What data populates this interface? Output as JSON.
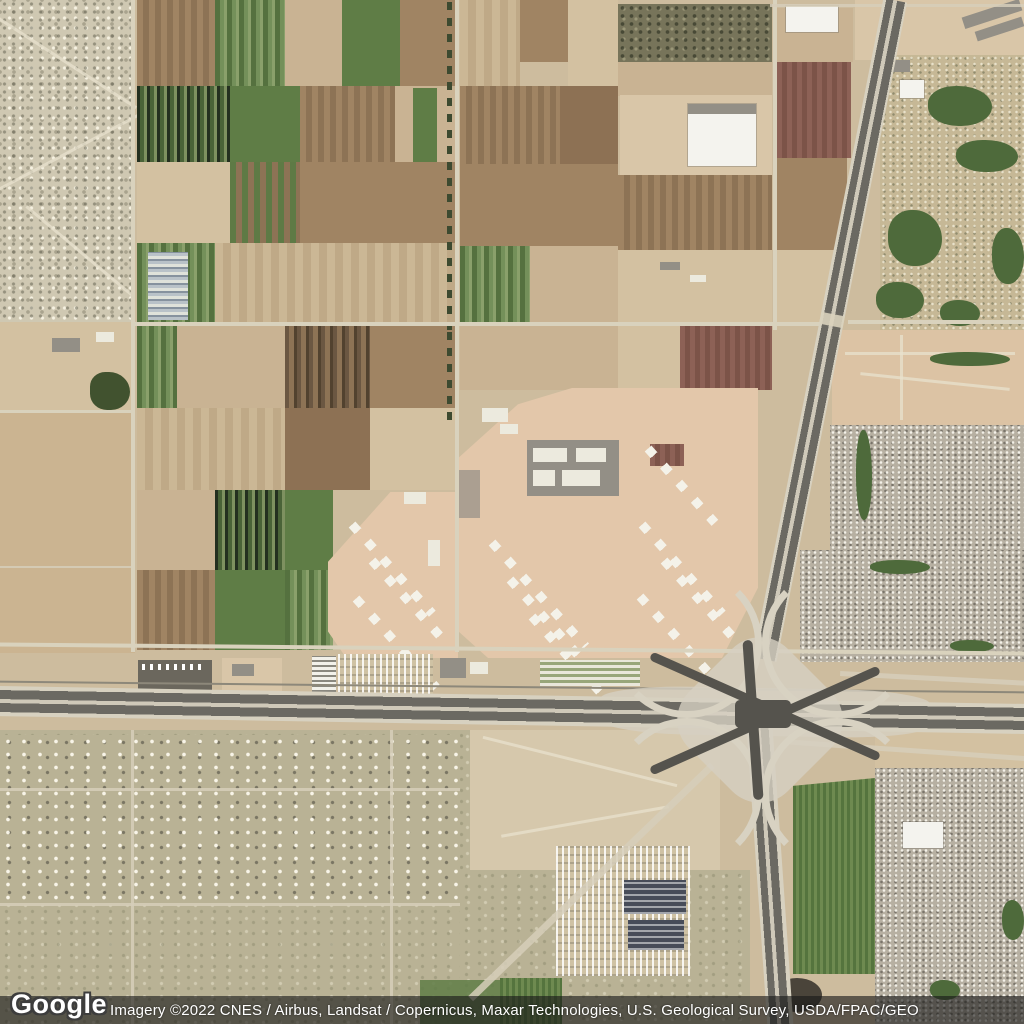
{
  "map_view": {
    "type": "satellite-imagery",
    "logo_text": "Google",
    "attribution_text": "Imagery ©2022 CNES / Airbus, Landsat / Copernicus, Maxar Technologies, U.S. Geological Survey, USDA/FPAC/GEO"
  },
  "palette": {
    "desert_base": "#cdbc9e",
    "field_tan": "#c9b393",
    "field_brown": "#a08463",
    "field_green": "#5f7d46",
    "field_maroon": "#8d6156",
    "prison_ground": "#e3c7aa",
    "golf_green": "#4e6a3b",
    "road_light": "#d9d2bd",
    "highway_asphalt": "#55534d",
    "attribution_bar": "rgba(25,25,25,0.62)",
    "attribution_text_color": "#ffffff"
  }
}
